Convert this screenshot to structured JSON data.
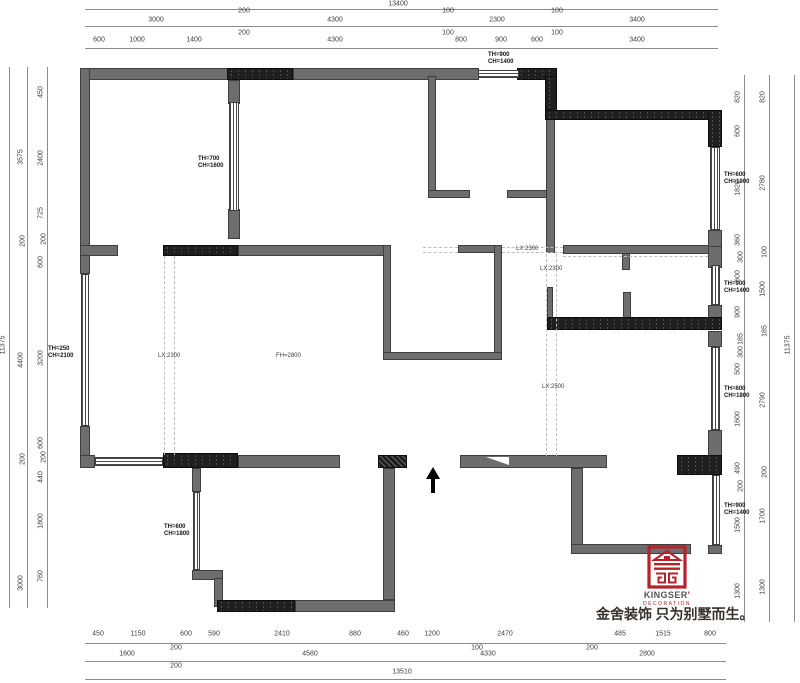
{
  "plan": {
    "colors": {
      "wall_gray": "#6d6d6d",
      "wall_black": "#1f1f1f",
      "dashed_line": "#bdbdbd",
      "dimension": "#3d3d3d",
      "brand_red": "#b5222a"
    },
    "walls": [
      [
        85,
        68,
        145,
        12,
        "g"
      ],
      [
        293,
        68,
        186,
        12,
        "g"
      ],
      [
        80,
        68,
        10,
        180,
        "g"
      ],
      [
        80,
        248,
        10,
        26,
        "g"
      ],
      [
        80,
        426,
        10,
        42,
        "g"
      ],
      [
        228,
        80,
        12,
        24,
        "g"
      ],
      [
        228,
        209,
        12,
        30,
        "g"
      ],
      [
        80,
        245,
        38,
        11,
        "g"
      ],
      [
        238,
        245,
        152,
        11,
        "g"
      ],
      [
        458,
        245,
        44,
        8,
        "g"
      ],
      [
        495,
        253,
        7,
        9,
        "g"
      ],
      [
        383,
        245,
        8,
        115,
        "g"
      ],
      [
        494,
        245,
        8,
        115,
        "g"
      ],
      [
        383,
        352,
        119,
        8,
        "g"
      ],
      [
        428,
        76,
        8,
        122,
        "g"
      ],
      [
        428,
        190,
        42,
        8,
        "g"
      ],
      [
        507,
        190,
        40,
        8,
        "g"
      ],
      [
        546,
        119,
        9,
        134,
        "g"
      ],
      [
        563,
        245,
        147,
        9,
        "g"
      ],
      [
        708,
        245,
        14,
        23,
        "g"
      ],
      [
        622,
        253,
        8,
        17,
        "g"
      ],
      [
        708,
        230,
        14,
        17,
        "g"
      ],
      [
        708,
        305,
        14,
        15,
        "g"
      ],
      [
        547,
        287,
        6,
        33,
        "g"
      ],
      [
        623,
        292,
        8,
        28,
        "g"
      ],
      [
        708,
        331,
        14,
        16,
        "g"
      ],
      [
        708,
        430,
        14,
        26,
        "g"
      ],
      [
        708,
        545,
        14,
        9,
        "g"
      ],
      [
        80,
        455,
        15,
        13,
        "g"
      ],
      [
        238,
        455,
        102,
        13,
        "g"
      ],
      [
        460,
        455,
        147,
        13,
        "g"
      ],
      [
        192,
        468,
        9,
        24,
        "g"
      ],
      [
        192,
        570,
        31,
        10,
        "g"
      ],
      [
        214,
        578,
        9,
        29,
        "g"
      ],
      [
        295,
        600,
        100,
        12,
        "g"
      ],
      [
        383,
        468,
        12,
        132,
        "g"
      ],
      [
        571,
        468,
        12,
        78,
        "g"
      ],
      [
        571,
        544,
        120,
        10,
        "g"
      ],
      [
        227,
        68,
        66,
        12,
        "b"
      ],
      [
        517,
        68,
        40,
        12,
        "b"
      ],
      [
        545,
        76,
        12,
        44,
        "b"
      ],
      [
        545,
        110,
        177,
        10,
        "b"
      ],
      [
        708,
        110,
        14,
        37,
        "b"
      ],
      [
        163,
        245,
        75,
        11,
        "b"
      ],
      [
        547,
        317,
        175,
        13,
        "b"
      ],
      [
        677,
        455,
        45,
        20,
        "b"
      ],
      [
        163,
        453,
        75,
        15,
        "b"
      ],
      [
        217,
        600,
        78,
        12,
        "b"
      ],
      [
        378,
        455,
        29,
        13,
        "c"
      ]
    ],
    "windows": [
      [
        478,
        70,
        41,
        8,
        "h"
      ],
      [
        229,
        102,
        10,
        109,
        "v"
      ],
      [
        81,
        274,
        8,
        152,
        "v"
      ],
      [
        710,
        147,
        10,
        83,
        "v"
      ],
      [
        711,
        265,
        9,
        40,
        "v"
      ],
      [
        711,
        347,
        9,
        83,
        "v"
      ],
      [
        712,
        475,
        8,
        70,
        "v"
      ],
      [
        193,
        492,
        7,
        78,
        "v"
      ],
      [
        95,
        457,
        68,
        9,
        "h"
      ]
    ],
    "dashed": [
      [
        164,
        256,
        164,
        455
      ],
      [
        174,
        256,
        174,
        455
      ],
      [
        423,
        247,
        458,
        247
      ],
      [
        502,
        247,
        563,
        247
      ],
      [
        423,
        252,
        458,
        252
      ],
      [
        502,
        252,
        563,
        252
      ],
      [
        563,
        256,
        708,
        256
      ],
      [
        546,
        254,
        546,
        456
      ],
      [
        556,
        254,
        556,
        456
      ]
    ]
  },
  "dimensions": {
    "lines": [
      [
        85,
        9,
        718,
        9
      ],
      [
        85,
        26,
        718,
        26
      ],
      [
        85,
        48,
        718,
        48
      ],
      [
        85,
        643,
        726,
        643
      ],
      [
        85,
        661,
        726,
        661
      ],
      [
        85,
        679,
        726,
        679
      ],
      [
        9,
        67,
        9,
        608
      ],
      [
        27,
        67,
        27,
        608
      ],
      [
        47,
        67,
        47,
        608
      ],
      [
        744,
        75,
        744,
        622
      ],
      [
        769,
        75,
        769,
        622
      ],
      [
        794,
        75,
        794,
        622
      ]
    ],
    "labels": [
      {
        "t": "13400",
        "x": 398,
        "y": 4
      },
      {
        "t": "3000",
        "x": 156,
        "y": 20
      },
      {
        "t": "200",
        "x": 244,
        "y": 11
      },
      {
        "t": "4300",
        "x": 335,
        "y": 20
      },
      {
        "t": "100",
        "x": 448,
        "y": 11
      },
      {
        "t": "2300",
        "x": 497,
        "y": 20
      },
      {
        "t": "100",
        "x": 557,
        "y": 11
      },
      {
        "t": "3400",
        "x": 637,
        "y": 20
      },
      {
        "t": "600",
        "x": 99,
        "y": 40
      },
      {
        "t": "1000",
        "x": 137,
        "y": 40
      },
      {
        "t": "1400",
        "x": 194,
        "y": 40
      },
      {
        "t": "200",
        "x": 244,
        "y": 33
      },
      {
        "t": "4300",
        "x": 335,
        "y": 40
      },
      {
        "t": "100",
        "x": 448,
        "y": 33
      },
      {
        "t": "800",
        "x": 461,
        "y": 40
      },
      {
        "t": "900",
        "x": 501,
        "y": 40
      },
      {
        "t": "600",
        "x": 537,
        "y": 40
      },
      {
        "t": "100",
        "x": 557,
        "y": 33
      },
      {
        "t": "3400",
        "x": 637,
        "y": 40
      },
      {
        "t": "450",
        "x": 98,
        "y": 634
      },
      {
        "t": "1150",
        "x": 138,
        "y": 634
      },
      {
        "t": "600",
        "x": 186,
        "y": 634
      },
      {
        "t": "590",
        "x": 214,
        "y": 634
      },
      {
        "t": "2410",
        "x": 282,
        "y": 634
      },
      {
        "t": "880",
        "x": 355,
        "y": 634
      },
      {
        "t": "460",
        "x": 403,
        "y": 634
      },
      {
        "t": "1200",
        "x": 432,
        "y": 634
      },
      {
        "t": "2470",
        "x": 505,
        "y": 634
      },
      {
        "t": "485",
        "x": 620,
        "y": 634
      },
      {
        "t": "1515",
        "x": 663,
        "y": 634
      },
      {
        "t": "800",
        "x": 710,
        "y": 634
      },
      {
        "t": "200",
        "x": 176,
        "y": 648
      },
      {
        "t": "100",
        "x": 477,
        "y": 648
      },
      {
        "t": "200",
        "x": 592,
        "y": 648
      },
      {
        "t": "1600",
        "x": 127,
        "y": 654
      },
      {
        "t": "4580",
        "x": 310,
        "y": 654
      },
      {
        "t": "4330",
        "x": 488,
        "y": 654
      },
      {
        "t": "2800",
        "x": 647,
        "y": 654
      },
      {
        "t": "200",
        "x": 176,
        "y": 666
      },
      {
        "t": "13510",
        "x": 402,
        "y": 672
      },
      {
        "t": "11375",
        "x": 3,
        "y": 345,
        "r": 1
      },
      {
        "t": "3575",
        "x": 21,
        "y": 157,
        "r": 1
      },
      {
        "t": "200",
        "x": 23,
        "y": 241,
        "r": 1
      },
      {
        "t": "4400",
        "x": 21,
        "y": 360,
        "r": 1
      },
      {
        "t": "200",
        "x": 23,
        "y": 459,
        "r": 1
      },
      {
        "t": "3000",
        "x": 21,
        "y": 583,
        "r": 1
      },
      {
        "t": "450",
        "x": 41,
        "y": 92,
        "r": 1
      },
      {
        "t": "2400",
        "x": 41,
        "y": 158,
        "r": 1
      },
      {
        "t": "725",
        "x": 41,
        "y": 213,
        "r": 1
      },
      {
        "t": "200",
        "x": 44,
        "y": 239,
        "r": 1
      },
      {
        "t": "600",
        "x": 41,
        "y": 262,
        "r": 1
      },
      {
        "t": "3200",
        "x": 41,
        "y": 358,
        "r": 1
      },
      {
        "t": "600",
        "x": 41,
        "y": 443,
        "r": 1
      },
      {
        "t": "200",
        "x": 44,
        "y": 457,
        "r": 1
      },
      {
        "t": "440",
        "x": 41,
        "y": 477,
        "r": 1
      },
      {
        "t": "1800",
        "x": 41,
        "y": 521,
        "r": 1
      },
      {
        "t": "760",
        "x": 41,
        "y": 576,
        "r": 1
      },
      {
        "t": "11375",
        "x": 788,
        "y": 345,
        "r": 1
      },
      {
        "t": "820",
        "x": 763,
        "y": 97,
        "r": 1
      },
      {
        "t": "2780",
        "x": 763,
        "y": 183,
        "r": 1
      },
      {
        "t": "100",
        "x": 765,
        "y": 252,
        "r": 1
      },
      {
        "t": "1500",
        "x": 763,
        "y": 289,
        "r": 1
      },
      {
        "t": "185",
        "x": 765,
        "y": 331,
        "r": 1
      },
      {
        "t": "2790",
        "x": 763,
        "y": 400,
        "r": 1
      },
      {
        "t": "200",
        "x": 765,
        "y": 472,
        "r": 1
      },
      {
        "t": "1700",
        "x": 763,
        "y": 516,
        "r": 1
      },
      {
        "t": "1300",
        "x": 763,
        "y": 587,
        "r": 1
      },
      {
        "t": "820",
        "x": 738,
        "y": 97,
        "r": 1
      },
      {
        "t": "600",
        "x": 738,
        "y": 131,
        "r": 1
      },
      {
        "t": "1820",
        "x": 738,
        "y": 188,
        "r": 1
      },
      {
        "t": "360",
        "x": 738,
        "y": 240,
        "r": 1
      },
      {
        "t": "300",
        "x": 741,
        "y": 257,
        "r": 1
      },
      {
        "t": "600",
        "x": 738,
        "y": 276,
        "r": 1
      },
      {
        "t": "900",
        "x": 738,
        "y": 312,
        "r": 1
      },
      {
        "t": "185",
        "x": 741,
        "y": 339,
        "r": 1
      },
      {
        "t": "300",
        "x": 741,
        "y": 352,
        "r": 1
      },
      {
        "t": "500",
        "x": 738,
        "y": 369,
        "r": 1
      },
      {
        "t": "1600",
        "x": 738,
        "y": 419,
        "r": 1
      },
      {
        "t": "490",
        "x": 738,
        "y": 468,
        "r": 1
      },
      {
        "t": "200",
        "x": 741,
        "y": 486,
        "r": 1
      },
      {
        "t": "1500",
        "x": 738,
        "y": 525,
        "r": 1
      },
      {
        "t": "1300",
        "x": 738,
        "y": 591,
        "r": 1
      }
    ]
  },
  "annotations": [
    {
      "t": "TH=900\nCH=1400",
      "x": 488,
      "y": 52
    },
    {
      "t": "TH=700\nCH=1600",
      "x": 198,
      "y": 156
    },
    {
      "t": "TH=250\nCH=2100",
      "x": 48,
      "y": 346
    },
    {
      "t": "TH=600\nCH=1800",
      "x": 164,
      "y": 524
    },
    {
      "t": "TH=600\nCH=1800",
      "x": 724,
      "y": 172
    },
    {
      "t": "TH=900\nCH=1400",
      "x": 724,
      "y": 281
    },
    {
      "t": "TH=600\nCH=1800",
      "x": 724,
      "y": 386
    },
    {
      "t": "TH=900\nCH=1400",
      "x": 724,
      "y": 503
    }
  ],
  "beam_labels": [
    {
      "t": "LX:2300",
      "x": 516,
      "y": 246
    },
    {
      "t": "LX:2300",
      "x": 540,
      "y": 266
    },
    {
      "t": "LX:2300",
      "x": 158,
      "y": 353
    },
    {
      "t": "FH=2800",
      "x": 276,
      "y": 353
    },
    {
      "t": "LX:2500",
      "x": 542,
      "y": 384
    }
  ],
  "logo": {
    "brand": "KINGSER",
    "mark": "'",
    "sub": "DECORATION",
    "slogan": "金舍装饰 只为别墅而生。"
  }
}
